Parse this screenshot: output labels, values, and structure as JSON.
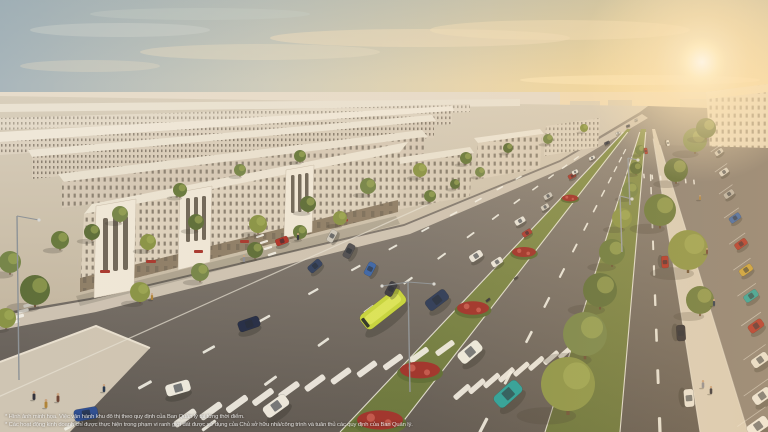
{
  "canvas": {
    "width": 768,
    "height": 432
  },
  "disclaimer": {
    "line1": "* Hình ảnh minh họa. Việc vận hành khu đô thị theo quy định của Ban Quản lý tại từng thời điểm.",
    "line2": "* Các hoạt động kinh doanh chỉ được thực hiện trong phạm vi ranh giới đất được sử dụng của Chủ sở hữu nhà/công trình và tuân thủ các quy định của Ban Quản lý."
  },
  "palette": {
    "sky_left": "#a9b6bb",
    "sky_right": "#f6dfae",
    "sun_core": "#fffef8",
    "sun_glow": "#ffe9bd",
    "horizon": "#e7dccb",
    "building_light": "#ece3d2",
    "building_face": "#ddd1bd",
    "building_shade": "#c2b29e",
    "window": "#675d50",
    "ground": "#cfc4b0",
    "asphalt_far": "#9a9186",
    "asphalt_near": "#5d5751",
    "marking": "#f2efe6",
    "grass": "#8a9450",
    "grass_dark": "#66733a",
    "bush": "#5c6c34",
    "flower": "#9e3029",
    "flower_light": "#c2554a",
    "sidewalk": "#d9cfbd",
    "bus": "#c6d43c",
    "bus_roof": "#dbe55a",
    "bus_rear": "#2e3429",
    "glass": "#232a33",
    "shadow": "#2c2a24",
    "trunk": "#6b5136",
    "lamp": "#d8d8d4",
    "skin": "#c9a27e",
    "tree_colors": [
      "#5f6f3a",
      "#77864a",
      "#8a9447",
      "#697a3e"
    ],
    "ped_colors": [
      "#32323c",
      "#b08438",
      "#6e4434",
      "#28384e",
      "#8c8c94"
    ]
  },
  "scene": {
    "vanishing_point": {
      "x": 648,
      "y": 106
    },
    "sun": {
      "x": 702,
      "y": 62
    },
    "lane_dashes": [
      {
        "bottom": 60,
        "start": 0.22,
        "end": 0.98,
        "count": 12
      },
      {
        "bottom": 200,
        "start": 0.16,
        "end": 0.98,
        "count": 13
      },
      {
        "bottom": 480,
        "start": 0.14,
        "end": 0.98,
        "count": 13
      },
      {
        "bottom": 660,
        "start": 0.22,
        "end": 0.98,
        "count": 10
      }
    ],
    "edge_lines": [
      {
        "bottom": -80,
        "t0": 0.3,
        "t1": 0.9,
        "w": 1.2,
        "c": "#e8e2d4",
        "o": 0.7
      },
      {
        "bottom": 340,
        "t0": 0.08,
        "t1": 1.0,
        "w": 1.1,
        "c": "#f2efe6",
        "o": 0.85
      },
      {
        "bottom": 395,
        "t0": 0.08,
        "t1": 1.0,
        "w": 1.1,
        "c": "#f2efe6",
        "o": 0.85
      },
      {
        "bottom": 545,
        "t0": 0.08,
        "t1": 1.0,
        "w": 1.1,
        "c": "#f2efe6",
        "o": 0.85
      },
      {
        "bottom": 620,
        "t0": 0.08,
        "t1": 1.0,
        "w": 1.1,
        "c": "#f2efe6",
        "o": 0.85
      },
      {
        "bottom": 700,
        "t0": 0.1,
        "t1": 1.0,
        "w": 1.0,
        "c": "#efeadd",
        "o": 0.7
      },
      {
        "bottom": 748,
        "t0": 0.12,
        "t1": 1.0,
        "w": 1.0,
        "c": "#efeadd",
        "o": 0.6
      }
    ],
    "crosswalks": [
      {
        "x1": 185,
        "y1": 418,
        "x2": 445,
        "y2": 348,
        "n": 11,
        "rot": -36,
        "len": 24,
        "wid": 6.5
      },
      {
        "x1": 462,
        "y1": 392,
        "x2": 566,
        "y2": 352,
        "n": 8,
        "rot": -41,
        "len": 20,
        "wid": 5.5
      },
      {
        "x1": 14,
        "y1": 322,
        "x2": 38,
        "y2": 294,
        "n": 6,
        "rot": -14,
        "len": 13,
        "wid": 4
      },
      {
        "x1": 252,
        "y1": 224,
        "x2": 272,
        "y2": 254,
        "n": 6,
        "rot": -18,
        "len": 13,
        "wid": 3.5
      },
      {
        "x1": 644,
        "y1": 176,
        "x2": 694,
        "y2": 182,
        "n": 7,
        "rot": 84,
        "len": 10,
        "wid": 3
      }
    ],
    "flowers": [
      [
        570,
        198,
        8
      ],
      [
        524,
        252,
        12
      ],
      [
        473,
        308,
        16
      ],
      [
        420,
        370,
        20
      ],
      [
        380,
        420,
        23
      ]
    ],
    "trees": [
      [
        35,
        290,
        15
      ],
      [
        10,
        262,
        11
      ],
      [
        6,
        318,
        10
      ],
      [
        60,
        240,
        9
      ],
      [
        92,
        232,
        8
      ],
      [
        120,
        214,
        8
      ],
      [
        148,
        242,
        8
      ],
      [
        180,
        190,
        7
      ],
      [
        196,
        222,
        8
      ],
      [
        240,
        170,
        6
      ],
      [
        258,
        224,
        9
      ],
      [
        300,
        156,
        6
      ],
      [
        308,
        204,
        8
      ],
      [
        368,
        186,
        8
      ],
      [
        420,
        170,
        7
      ],
      [
        466,
        158,
        6
      ],
      [
        508,
        148,
        5
      ],
      [
        548,
        139,
        5
      ],
      [
        584,
        128,
        4
      ],
      [
        430,
        196,
        6
      ],
      [
        455,
        184,
        5
      ],
      [
        480,
        172,
        5
      ],
      [
        340,
        218,
        7
      ],
      [
        300,
        232,
        7
      ],
      [
        255,
        250,
        8
      ],
      [
        200,
        272,
        9
      ],
      [
        140,
        292,
        10
      ],
      [
        640,
        150,
        5
      ],
      [
        636,
        168,
        6
      ],
      [
        630,
        190,
        8
      ],
      [
        622,
        218,
        10
      ],
      [
        612,
        252,
        13
      ],
      [
        600,
        290,
        17
      ],
      [
        585,
        334,
        22
      ],
      [
        568,
        384,
        27
      ],
      [
        660,
        210,
        16
      ],
      [
        676,
        170,
        12
      ],
      [
        695,
        140,
        12
      ],
      [
        688,
        250,
        20
      ],
      [
        700,
        300,
        14
      ],
      [
        706,
        128,
        10
      ]
    ],
    "vehicles": [
      {
        "x": 383,
        "y": 309,
        "l": 50,
        "w": 18,
        "rot": -38,
        "c": "#c6d43c",
        "type": "bus"
      },
      {
        "x": 437,
        "y": 300,
        "l": 24,
        "w": 12,
        "rot": -37,
        "c": "#2c3a58"
      },
      {
        "x": 315,
        "y": 266,
        "l": 15,
        "w": 8,
        "rot": -41,
        "c": "#32415f"
      },
      {
        "x": 476,
        "y": 256,
        "l": 14,
        "w": 7.5,
        "rot": -33,
        "c": "#e8e4da"
      },
      {
        "x": 520,
        "y": 221,
        "l": 11,
        "w": 6,
        "rot": -31,
        "c": "#e6e2d8"
      },
      {
        "x": 548,
        "y": 196,
        "l": 9,
        "w": 5,
        "rot": -30,
        "c": "#c9c4ba"
      },
      {
        "x": 572,
        "y": 176,
        "l": 8,
        "w": 4.5,
        "rot": -28,
        "c": "#a83a30"
      },
      {
        "x": 592,
        "y": 158,
        "l": 6.5,
        "w": 3.5,
        "rot": -26,
        "c": "#e4e0d6"
      },
      {
        "x": 607,
        "y": 143,
        "l": 5.5,
        "w": 3,
        "rot": -25,
        "c": "#4a4a52"
      },
      {
        "x": 470,
        "y": 352,
        "l": 26,
        "w": 13,
        "rot": -40,
        "c": "#eceade"
      },
      {
        "x": 508,
        "y": 394,
        "l": 30,
        "w": 15,
        "rot": -42,
        "c": "#27a09b"
      },
      {
        "x": 497,
        "y": 262,
        "l": 12,
        "w": 6.5,
        "rot": -33,
        "c": "#eae6dc"
      },
      {
        "x": 527,
        "y": 233,
        "l": 10,
        "w": 5.5,
        "rot": -32,
        "c": "#ab3a31"
      },
      {
        "x": 545,
        "y": 207,
        "l": 8.5,
        "w": 5,
        "rot": -30,
        "c": "#cfcabe"
      },
      {
        "x": 575,
        "y": 172,
        "l": 6.5,
        "w": 4,
        "rot": -27,
        "c": "#e8e4da"
      },
      {
        "x": 488,
        "y": 300,
        "l": 5,
        "w": 2.2,
        "rot": -38,
        "c": "#3a3a40"
      },
      {
        "x": 516,
        "y": 278,
        "l": 4.5,
        "w": 2,
        "rot": -34,
        "c": "#55504a"
      },
      {
        "x": 618,
        "y": 133,
        "l": 4.5,
        "w": 2.5,
        "rot": -24,
        "c": "#dddad0"
      },
      {
        "x": 628,
        "y": 126,
        "l": 4,
        "w": 2.2,
        "rot": -23,
        "c": "#5a5a60"
      },
      {
        "x": 636,
        "y": 120,
        "l": 3.5,
        "w": 2,
        "rot": -22,
        "c": "#c7c2b8"
      },
      {
        "x": 665,
        "y": 262,
        "l": 12,
        "w": 7,
        "rot": 86,
        "c": "#b03228"
      },
      {
        "x": 681,
        "y": 333,
        "l": 16,
        "w": 9,
        "rot": 86,
        "c": "#2e2e36"
      },
      {
        "x": 689,
        "y": 398,
        "l": 18,
        "w": 10,
        "rot": 85,
        "c": "#e9e5da"
      },
      {
        "x": 332,
        "y": 236,
        "l": 13,
        "w": 7,
        "rot": -62,
        "c": "#cdc8bc"
      },
      {
        "x": 349,
        "y": 251,
        "l": 15,
        "w": 8,
        "rot": -62,
        "c": "#4f4e52"
      },
      {
        "x": 370,
        "y": 269,
        "l": 14,
        "w": 8,
        "rot": -62,
        "c": "#3c66a8"
      },
      {
        "x": 391,
        "y": 289,
        "l": 15,
        "w": 8,
        "rot": -62,
        "c": "#3a3a40"
      },
      {
        "x": 282,
        "y": 241,
        "l": 13,
        "w": 7,
        "rot": -20,
        "c": "#b13329"
      },
      {
        "x": 86,
        "y": 414,
        "l": 24,
        "w": 12,
        "rot": -10,
        "c": "#2f4f92"
      },
      {
        "x": 178,
        "y": 388,
        "l": 25,
        "w": 12,
        "rot": -16,
        "c": "#ece8dd"
      },
      {
        "x": 249,
        "y": 324,
        "l": 22,
        "w": 11,
        "rot": -19,
        "c": "#232c46"
      },
      {
        "x": 276,
        "y": 406,
        "l": 27,
        "w": 13,
        "rot": -36,
        "c": "#ebe7dc"
      },
      {
        "x": 646,
        "y": 151,
        "l": 6,
        "w": 3,
        "rot": 80,
        "c": "#b03228"
      },
      {
        "x": 668,
        "y": 143,
        "l": 6,
        "w": 3,
        "rot": 78,
        "c": "#e8e4da"
      }
    ],
    "parked_right": [
      {
        "x": 719,
        "y": 152,
        "l": 9,
        "w": 5,
        "rot": -35,
        "c": "#cfc9bd"
      },
      {
        "x": 724,
        "y": 172,
        "l": 10,
        "w": 5.5,
        "rot": -35,
        "c": "#d8d3c8"
      },
      {
        "x": 729,
        "y": 194,
        "l": 11,
        "w": 6,
        "rot": -35,
        "c": "#b9b4aa"
      },
      {
        "x": 735,
        "y": 218,
        "l": 12,
        "w": 6.5,
        "rot": -35,
        "c": "#3e68aa"
      },
      {
        "x": 741,
        "y": 244,
        "l": 13,
        "w": 7,
        "rot": -35,
        "c": "#b0342b"
      },
      {
        "x": 746,
        "y": 270,
        "l": 14,
        "w": 7.5,
        "rot": -35,
        "c": "#c9a23a"
      },
      {
        "x": 751,
        "y": 296,
        "l": 15,
        "w": 8,
        "rot": -35,
        "c": "#2aa39d"
      },
      {
        "x": 756,
        "y": 326,
        "l": 16,
        "w": 9,
        "rot": -35,
        "c": "#b0342b"
      },
      {
        "x": 760,
        "y": 360,
        "l": 18,
        "w": 10,
        "rot": -35,
        "c": "#e9e5da"
      },
      {
        "x": 762,
        "y": 396,
        "l": 20,
        "w": 11,
        "rot": -35,
        "c": "#edebe2"
      },
      {
        "x": 758,
        "y": 426,
        "l": 23,
        "w": 12,
        "rot": -35,
        "c": "#f0eee6"
      }
    ],
    "pedestrians": [
      [
        34,
        400,
        9
      ],
      [
        46,
        408,
        9
      ],
      [
        58,
        402,
        9
      ],
      [
        104,
        392,
        8
      ],
      [
        244,
        262,
        7
      ],
      [
        298,
        240,
        7
      ],
      [
        700,
        200,
        5
      ],
      [
        707,
        254,
        6
      ],
      [
        714,
        306,
        7
      ],
      [
        703,
        388,
        8
      ],
      [
        711,
        394,
        8
      ],
      [
        152,
        300,
        7
      ]
    ],
    "poles": [
      {
        "x": 410,
        "y": 392,
        "top": 282,
        "arms": [
          [
            -26,
            4
          ],
          [
            26,
            2
          ]
        ],
        "c": "#8e9397"
      },
      {
        "x": 19,
        "y": 380,
        "top": 216,
        "arms": [
          [
            22,
            4
          ]
        ],
        "c": "#8e9397"
      },
      {
        "x": 630,
        "y": 205,
        "top": 158,
        "arms": [
          [
            10,
            2
          ]
        ],
        "c": "#9a9fa3"
      },
      {
        "x": 622,
        "y": 252,
        "top": 196,
        "arms": [
          [
            12,
            3
          ]
        ],
        "c": "#9a9fa3"
      }
    ]
  }
}
